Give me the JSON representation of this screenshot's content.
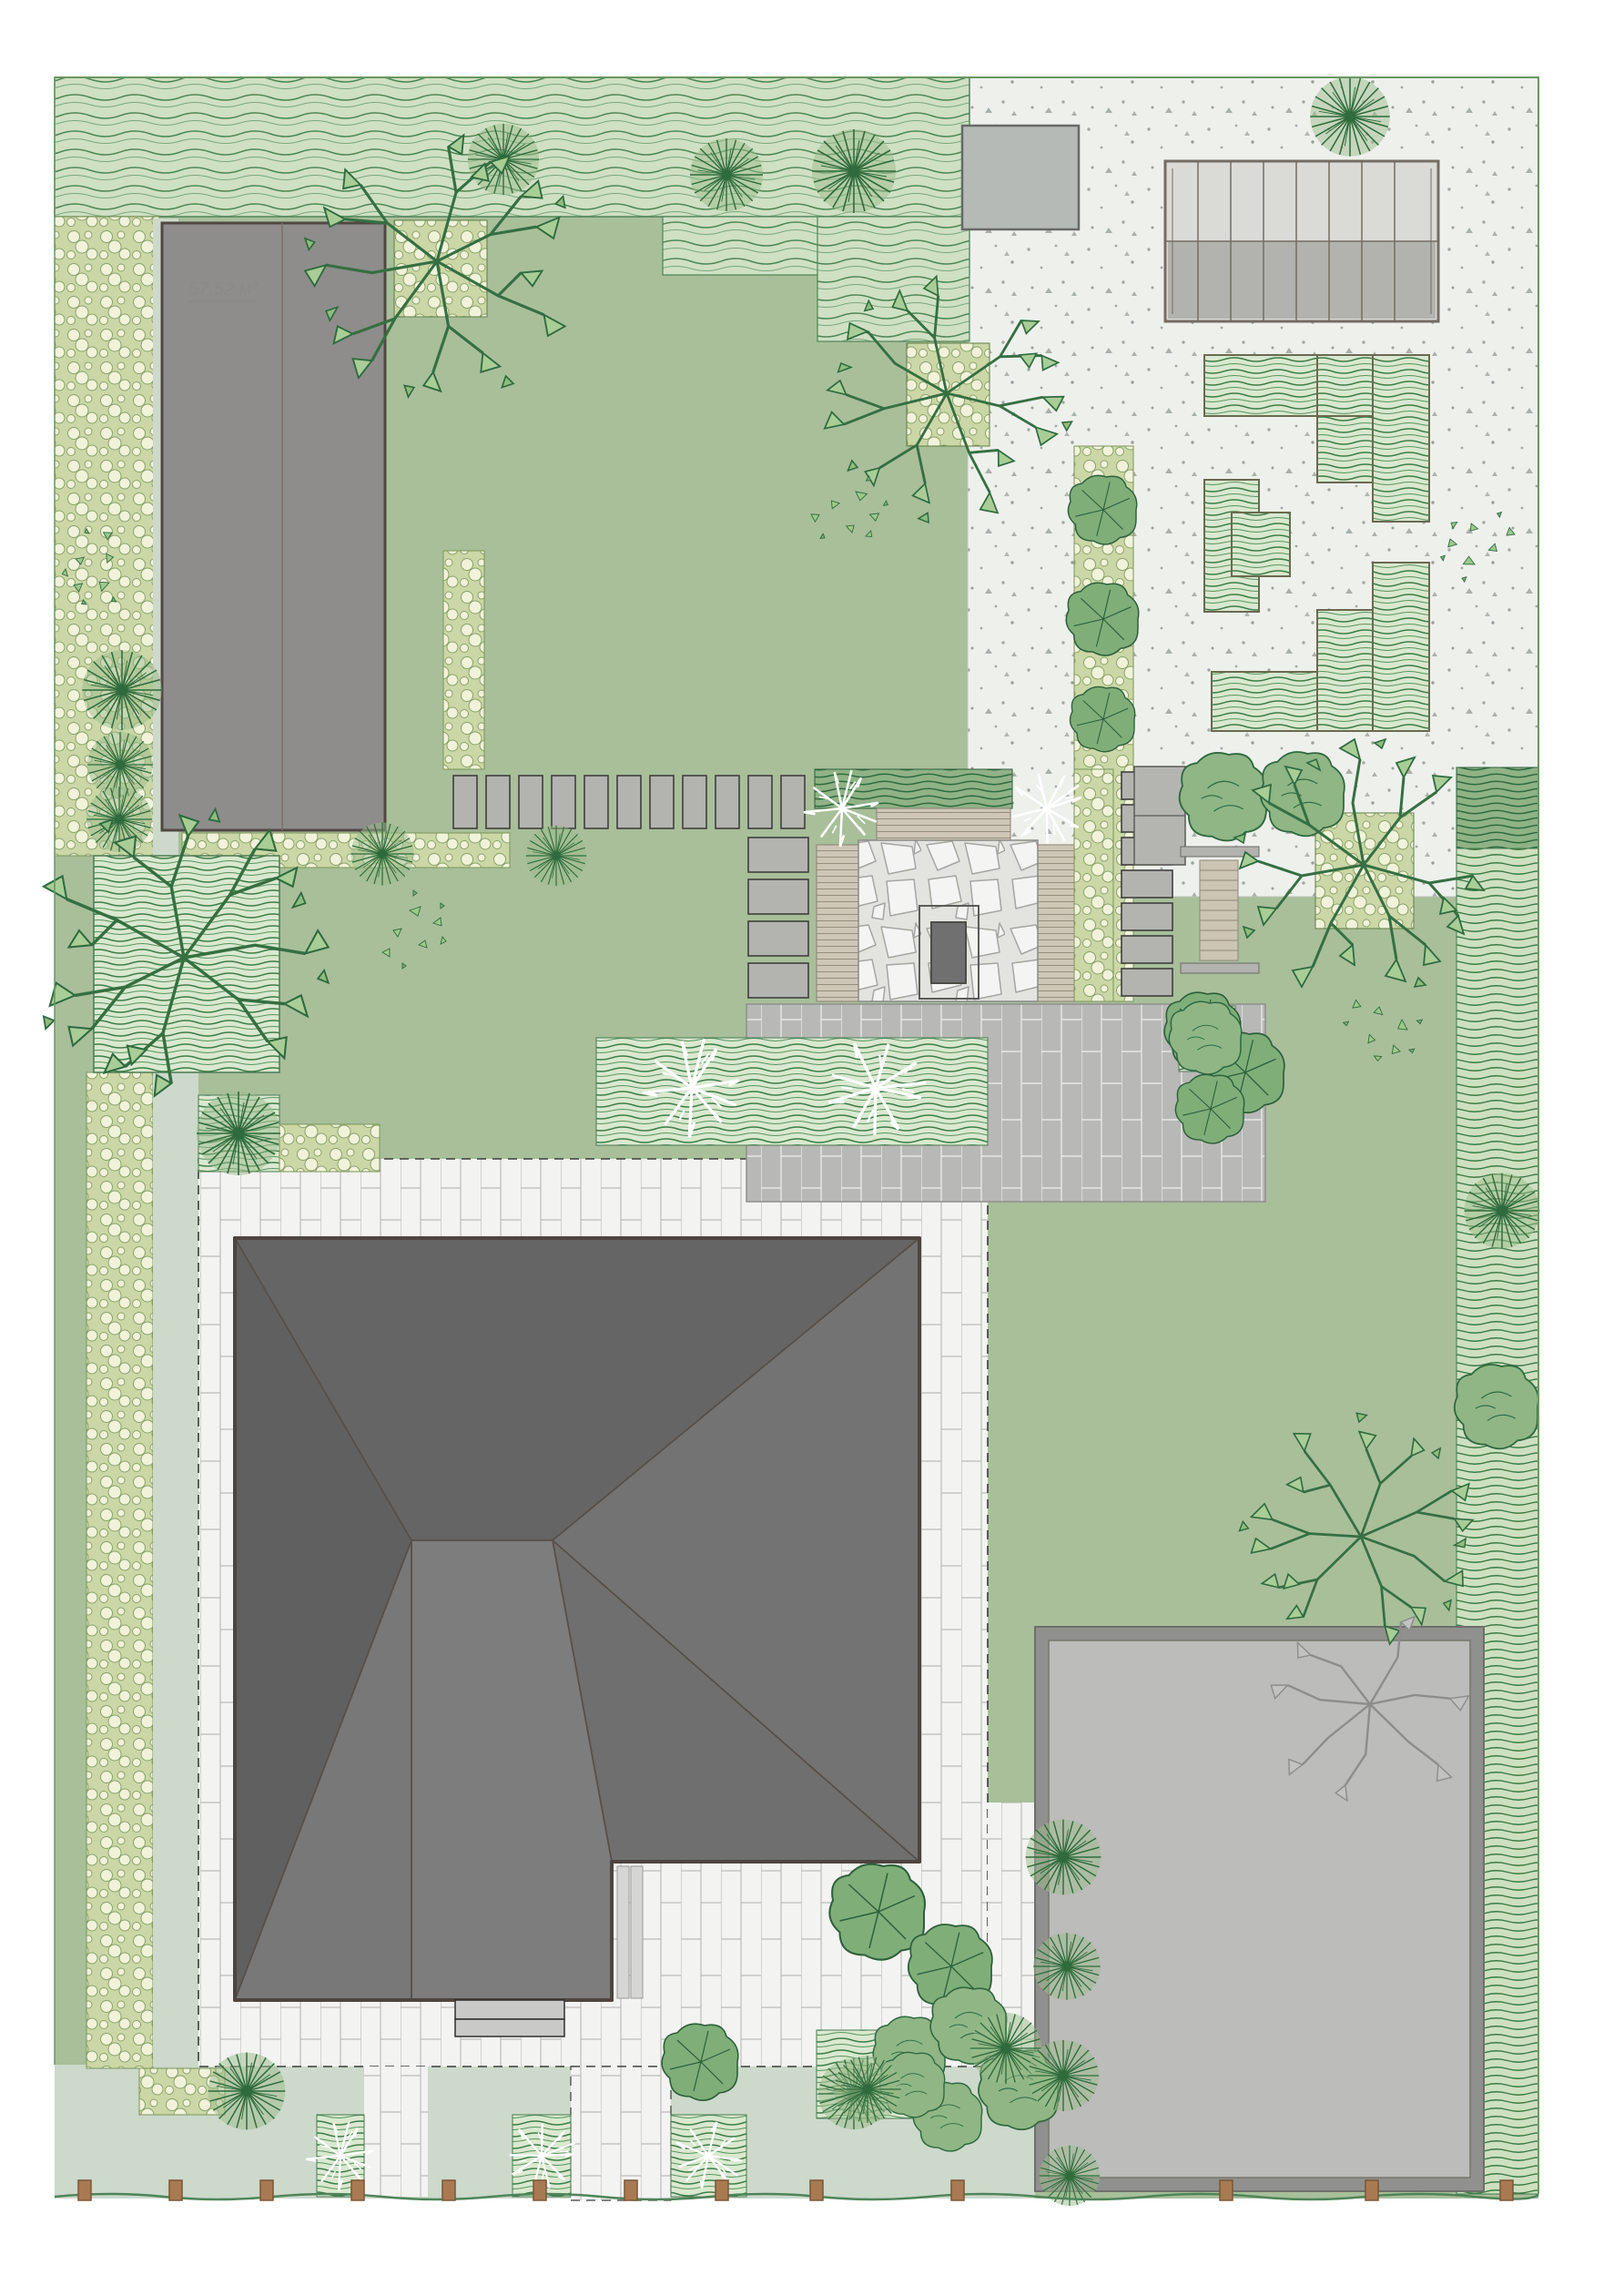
{
  "plan": {
    "title": "landscape-site-plan",
    "garage_area_label": "57,52 м²"
  },
  "colors": {
    "page": "#ffffff",
    "lawn": "#a8bf9a",
    "sage": "#ccd9cb",
    "gravel": "#eef0ec",
    "gravel_speck": "#a4a9a3",
    "wavy_band": "#cfe0c3",
    "wave_line": "#4e8656",
    "circle_bed_bg": "#cbd7a6",
    "circle_fill": "#f0f3da",
    "circle_stroke": "#8ba26b",
    "bed_stripe_bg": "#d9e9cf",
    "bed_stripe_line": "#3f7c4a",
    "hedge_bg": "#cde0c0",
    "hedge_dark_bg": "#8fb286",
    "pave_white": "#f3f3f1",
    "pave_white_joint": "#bcbcb9",
    "pave_gray": "#b8b8b6",
    "pave_gray_joint": "#e7e7e5",
    "deck_wood": "#cec7b7",
    "deck_line": "#968e7c",
    "flagstone_bg": "#e3e3e0",
    "flagstone_stone": "#f4f4f2",
    "roof_dark": "#656565",
    "roof_mid": "#737373",
    "roof_light": "#7d7d7d",
    "roof_border": "#4e4440",
    "garage_fill": "#8e8d8b",
    "garage_border": "#504743",
    "pad_fill": "#bcbcba",
    "pad_frame": "#90908e",
    "greenhouse_glass_light": "#dadbd7",
    "greenhouse_glass_dark": "#b2b3ae",
    "greenhouse_frame": "#756c63",
    "tree_line": "#2f6b3c",
    "tree_fill": "#9cbb8c",
    "cloud_fill": "#8fb684",
    "branch_line": "#356f42",
    "leaf_fill": "#a9cd96",
    "white_shrub": "#ffffff",
    "fence_post": "#a97a52",
    "stone_fill": "#b3b3b0",
    "step_fill": "#c9c9c7",
    "site_edge": "#69995f",
    "label": "#8a8a88"
  },
  "inventory": {
    "buildings": [
      "garage",
      "greenhouse",
      "house",
      "parking-pad",
      "utility-pad"
    ],
    "paths": [
      "stepping-stone-row",
      "stepping-stone-column",
      "slab-column",
      "front-path",
      "entry-steps"
    ],
    "features": [
      "fire-pit",
      "flagstone-patio",
      "wood-decks",
      "picnic-table",
      "garden-bench",
      "vegetable-beds",
      "fence-posts"
    ]
  }
}
